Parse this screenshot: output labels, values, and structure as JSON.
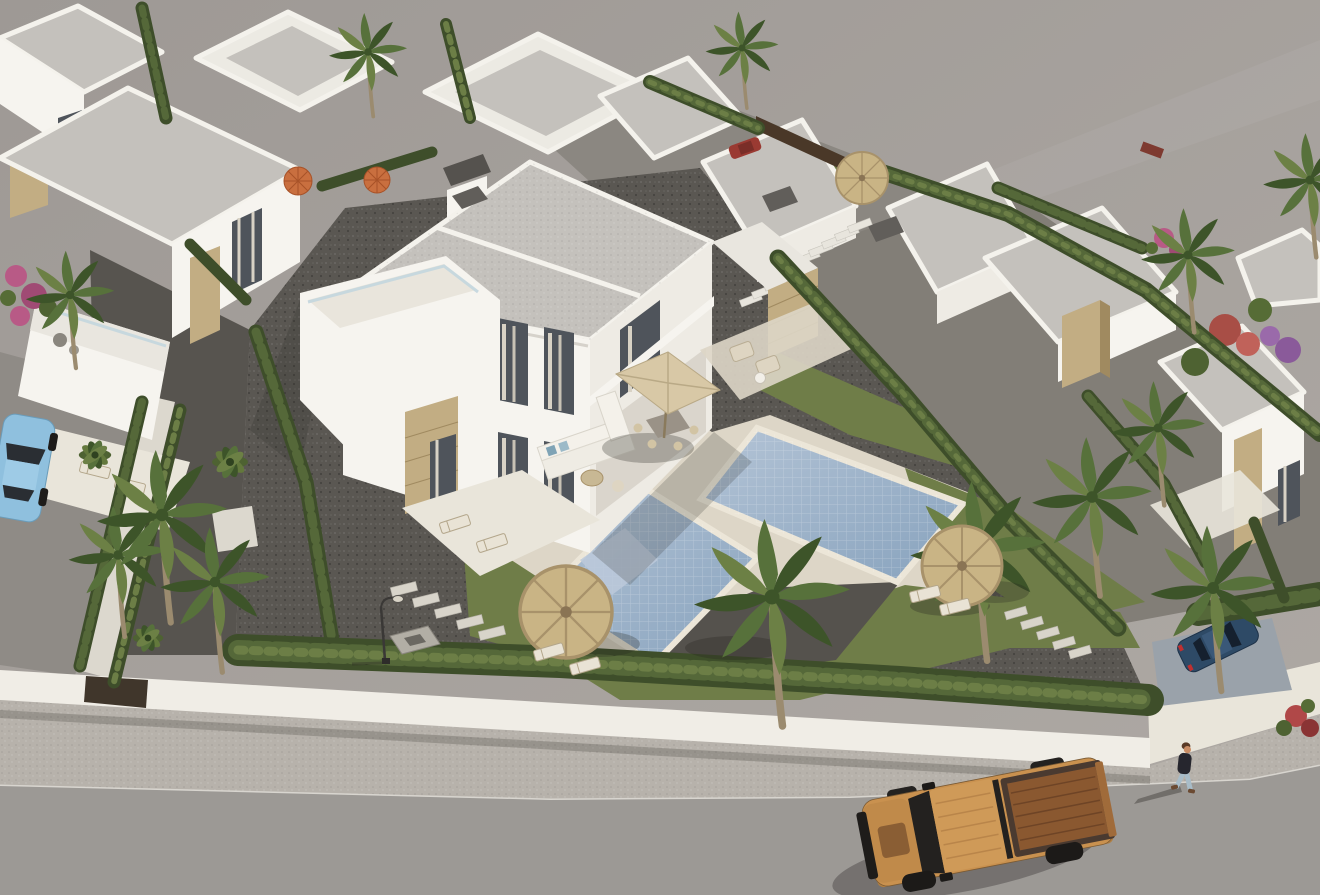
{
  "scene": {
    "type": "3d_architectural_aerial_render",
    "description": "High-angle aerial render of a modern Mediterranean villa development: a central two-storey semi-detached white villa with stone accent panels, two private mosaic pools, palm trees and cypress hedges, gravel driveways behind a white perimeter wall, a sidewalk and asphalt road with an orange pickup truck driving past, a pedestrian walking, parked cars, and empty grey land beyond the development",
    "lighting": "low warm sun casting long shadows toward lower-left",
    "elements": [
      "main semi-detached villa",
      "rows of white flat-roof villas",
      "two swimming pools",
      "palm trees",
      "cypress hedges",
      "straw parasols",
      "orange parasols",
      "outdoor sofa set",
      "dining parasol table",
      "sun loungers",
      "white perimeter wall with gate",
      "gravel driveway",
      "stepping stones",
      "street lamp",
      "sidewalk",
      "asphalt road",
      "orange pickup truck",
      "pedestrian",
      "light blue parked car",
      "navy parked car",
      "red parked car",
      "vacant grey land",
      "bougainvillea and ornamental shrubs",
      "external roof stairs"
    ]
  },
  "colors": {
    "vacant_land": "#a6a19d",
    "road": "#9c9995",
    "sidewalk": "#b7b2ab",
    "curb": "#d8d5cf",
    "perimeter_wall": "#f0ede6",
    "gate": "#40362b",
    "plot_gravel": "#5a5752",
    "back_gravel": "#8b8781",
    "right_gravel": "#827e77",
    "street_left": "#8f8b86",
    "paving": "#ddd6c7",
    "paving_light": "#e9e5da",
    "path_white": "#dcd8ce",
    "driveway_concrete": "#9aa2aa",
    "lawn": "#6f7d48",
    "pool_deep": "#8ba6bf",
    "pool_steps": "#bcc9da",
    "pool_coping": "#ece6d8",
    "roof": "#c4c1bc",
    "house_white": "#f6f4ef",
    "house_shade": "#eeebe4",
    "house_dark": "#cfccc5",
    "stone": "#c2ad83",
    "stone_dark": "#a08a60",
    "chimney": "#615e5a",
    "glass": "#4f545b",
    "curtain": "#d8d2c5",
    "hedge_dark": "#3e4e2a",
    "hedge_mid": "#556839",
    "hedge_light": "#6c7e46",
    "palm_green": "#57713b",
    "palm_dark": "#3d5429",
    "trunk": "#9b8b6f",
    "straw": "#c9b485",
    "straw_dark": "#a8926a",
    "parasol_orange": "#c96f3f",
    "truck_body": "#c9914f",
    "truck_hood": "#c08a4a",
    "truck_roof": "#cf9a58",
    "truck_bed": "#8a5830",
    "truck_dark": "#23211f",
    "car_blue": "#8fc0de",
    "car_navy": "#2e4a66",
    "car_red": "#9a3a32",
    "taillight": "#c03030",
    "skin": "#c98c64",
    "hair": "#5a3a26",
    "shirt": "#26262e",
    "jeans": "#a8bcc8",
    "shoe": "#6b4a32",
    "flower_pink": "#b85a86",
    "flower_red": "#b04848",
    "flower_purple": "#8a5a9a",
    "shadow": "rgba(40,38,34,0.28)"
  },
  "counts": {
    "pools": 2,
    "straw_parasols": 3,
    "orange_parasols": 2,
    "palm_trees": 13,
    "vehicles": 4,
    "pedestrians": 1
  }
}
